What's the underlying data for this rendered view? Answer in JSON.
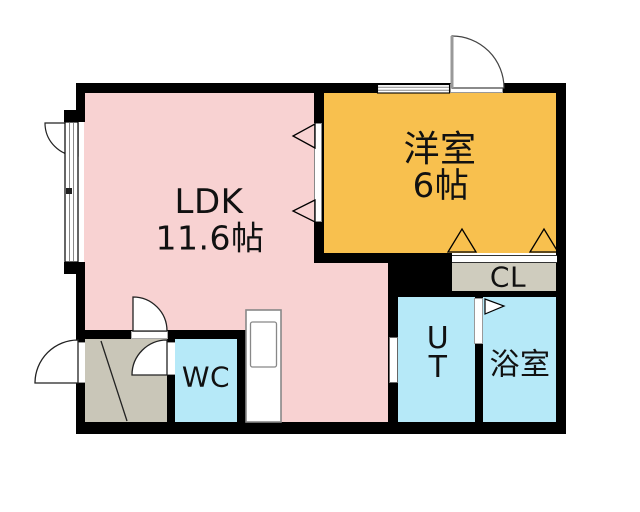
{
  "floorplan": {
    "rooms": {
      "ldk": {
        "name": "LDK",
        "area": "11.6帖"
      },
      "western_room": {
        "name": "洋室",
        "area": "6帖"
      },
      "closet": {
        "name": "CL"
      },
      "wc": {
        "name": "WC"
      },
      "utility": {
        "name": "UT"
      },
      "bathroom": {
        "name": "浴室"
      }
    }
  },
  "colors": {
    "background": "#ffffff",
    "wall": "#000000",
    "ldk": "#f8d2d2",
    "western_room": "#f8c04e",
    "wet_rooms": "#b6e9f8",
    "closet": "#cfccbe",
    "entrance": "#c9c6b8"
  }
}
